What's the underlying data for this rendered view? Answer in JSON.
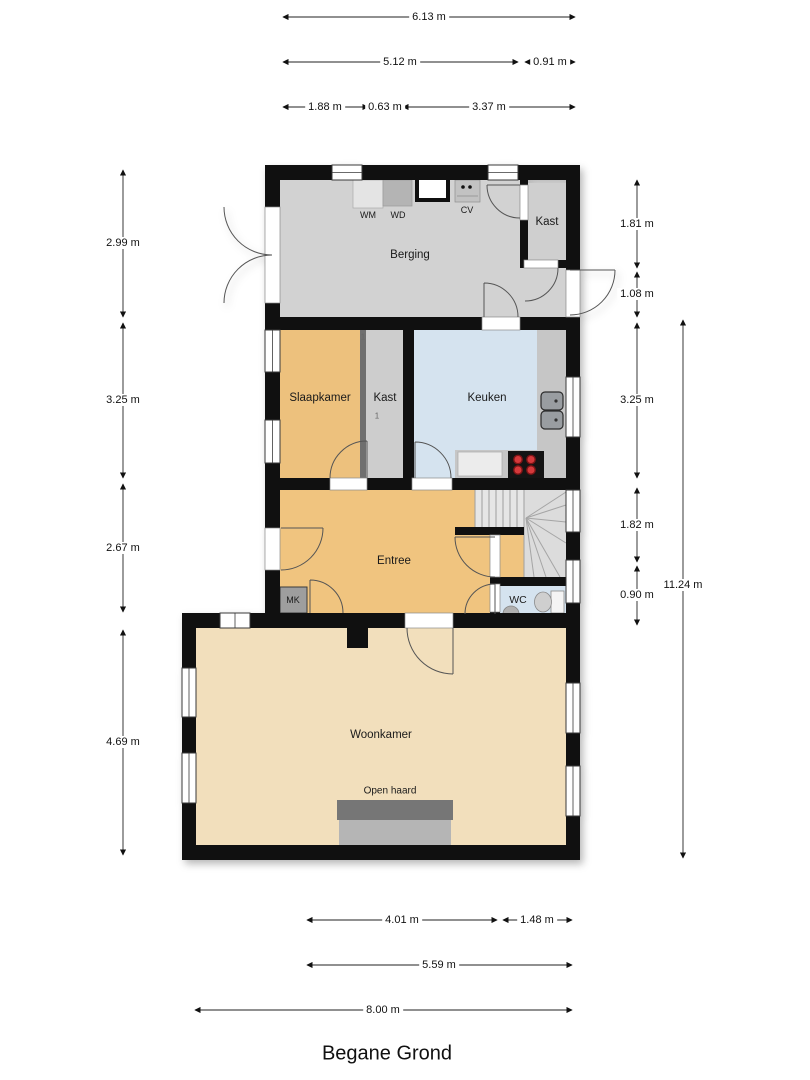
{
  "title": "Begane Grond",
  "rooms": {
    "berging": "Berging",
    "kast_boven": "Kast",
    "slaapkamer": "Slaapkamer",
    "kast": "Kast",
    "keuken": "Keuken",
    "entree": "Entree",
    "mk": "MK",
    "wc": "WC",
    "woonkamer": "Woonkamer",
    "open_haard": "Open haard"
  },
  "appliances": {
    "wm": "WM",
    "wd": "WD",
    "cv": "CV"
  },
  "annotations": {
    "door_mark_a": "1",
    "door_mark_b": "1"
  },
  "dimensions": {
    "top": [
      "6.13 m",
      "5.12 m",
      "0.91 m",
      "1.88 m",
      "0.63 m",
      "3.37 m"
    ],
    "left": [
      "2.99 m",
      "3.25 m",
      "2.67 m",
      "4.69 m"
    ],
    "right": [
      "1.81 m",
      "1.08 m",
      "3.25 m",
      "1.82 m",
      "0.90 m",
      "11.24 m"
    ],
    "bottom": [
      "4.01 m",
      "1.48 m",
      "5.59 m",
      "8.00 m"
    ]
  },
  "colors": {
    "wall": "#101010",
    "storage_gray": "#d2d2d2",
    "closet_gray": "#cdcdcd",
    "bedroom_orange": "#edc17d",
    "entree_orange": "#f0c47f",
    "kitchen_blue": "#d5e3ef",
    "living_tan": "#f2dfbc",
    "counter_gray": "#c6c6c6",
    "fireplace_dark": "#767676",
    "fireplace_light": "#b5b5b5",
    "burner_red": "#d5393b"
  }
}
